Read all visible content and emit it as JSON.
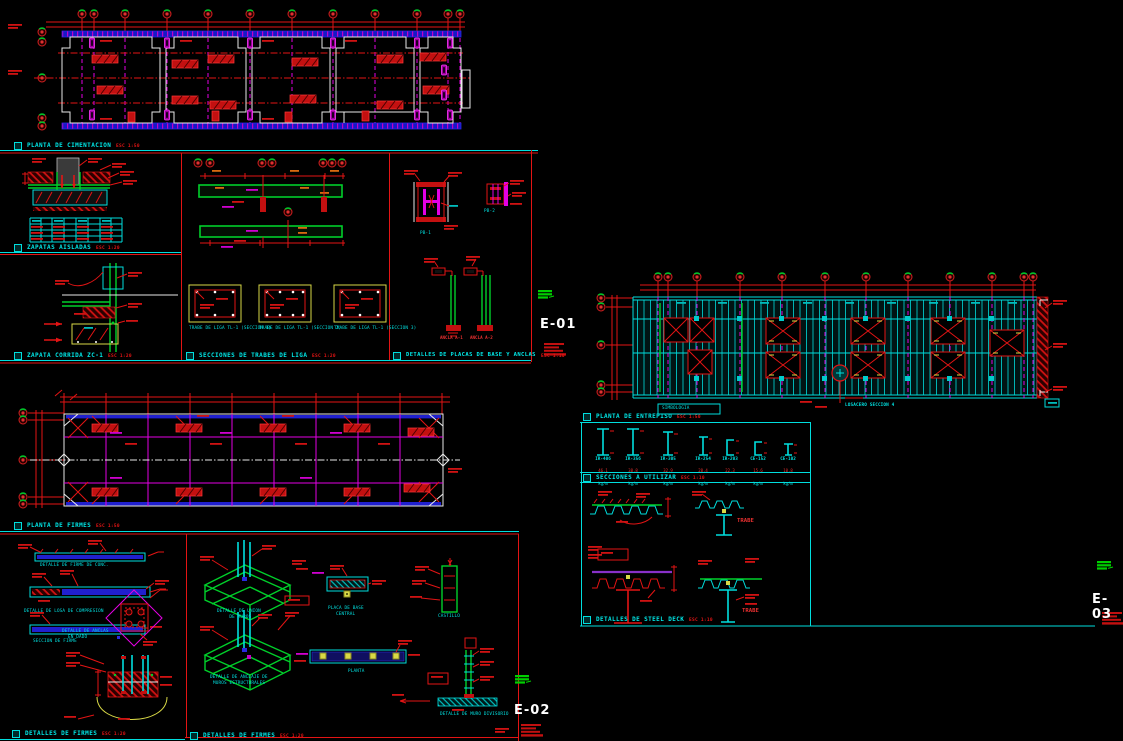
{
  "app": {
    "kind": "cad-structural-sheet-set",
    "background": "#000000"
  },
  "colors": {
    "cyan": "#00dede",
    "red": "#e31414",
    "magenta": "#e400e4",
    "blue": "#1818c8",
    "green": "#00cf2a",
    "yellow": "#d9d946",
    "white": "#ffffff"
  },
  "sheet_labels": {
    "e01": "E-01",
    "e02": "E-02",
    "e03": "E-03"
  },
  "titles": {
    "planta_cimentacion": {
      "text": "PLANTA DE CIMENTACION",
      "scale": "ESC 1:50"
    },
    "zapatas_aisladas": {
      "text": "ZAPATAS AISLADAS",
      "scale": "ESC 1:20"
    },
    "zapata_corrida": {
      "text": "ZAPATA CORRIDA ZC-1",
      "scale": "ESC 1:20"
    },
    "secciones_trabes": {
      "text": "SECCIONES DE TRABES DE LIGA",
      "scale": "ESC 1:20"
    },
    "detalles_placas": {
      "text": "DETALLES DE PLACAS DE BASE Y ANCLAS",
      "scale": "ESC 1:10"
    },
    "planta_entrepiso": {
      "text": "PLANTA DE ENTREPISO",
      "scale": "ESC 1:50"
    },
    "secciones_utilizar": {
      "text": "SECCIONES A UTILIZAR",
      "scale": "ESC 1:10"
    },
    "detalles_steel_deck": {
      "text": "DETALLES DE STEEL DECK",
      "scale": "ESC 1:10"
    },
    "planta_firmes": {
      "text": "PLANTA DE FIRMES",
      "scale": "ESC 1:50"
    },
    "detalles_firmes_izq": {
      "text": "DETALLES DE FIRMES",
      "scale": "ESC 1:20"
    },
    "detalles_firmes_der": {
      "text": "DETALLES DE FIRMES",
      "scale": "ESC 1:20"
    }
  },
  "captions": {
    "seccion1": "TRABE DE LIGA TL-1 (SECCION 1)",
    "seccion2": "TRABE DE LIGA TL-1 (SECCION 2)",
    "seccion3": "TRABE DE LIGA TL-1 (SECCION 3)",
    "pb1": "PB-1",
    "pb2": "PB-2",
    "ancla1": "ANCLA A-1",
    "ancla2": "ANCLA A-2",
    "firme_conc": "DETALLE DE FIRME DE CONC.",
    "losa_compresion": "DETALLE DE LOSA DE COMPRESION",
    "seccion_firme": "SECCION DE FIRME",
    "anclas_dado_1": "DETALLE DE ANCLAS",
    "anclas_dado_2": "EN DADO",
    "union_muros_1": "DETALLE DE UNION",
    "union_muros_2": "DE MUROS",
    "anclaje_muros_1": "DETALLE DE ANCLAJE DE",
    "anclaje_muros_2": "MUROS ESTRUCTURALES",
    "placa_base_1": "PLACA DE BASE",
    "placa_base_2": "CENTRAL",
    "planta": "PLANTA",
    "castillo": "CASTILLO",
    "muro_divisorio": "DETALLE DE MURO DIVISORIO",
    "trabe_label": "TRABE",
    "simbologia": "SIMBOLOGIA",
    "nota_losacero": "LOSACERO SECCION 4"
  },
  "profiles": {
    "items": [
      {
        "name": "IR-406",
        "weight": "46.1",
        "unit": "kg/m"
      },
      {
        "name": "IR-356",
        "weight": "38.8",
        "unit": "kg/m"
      },
      {
        "name": "IR-305",
        "weight": "32.9",
        "unit": "kg/m"
      },
      {
        "name": "IR-254",
        "weight": "28.4",
        "unit": "kg/m"
      },
      {
        "name": "IR-203",
        "weight": "22.3",
        "unit": "kg/m"
      },
      {
        "name": "CE-152",
        "weight": "15.6",
        "unit": "kg/m"
      },
      {
        "name": "CE-102",
        "weight": "10.8",
        "unit": "kg/m"
      }
    ]
  }
}
